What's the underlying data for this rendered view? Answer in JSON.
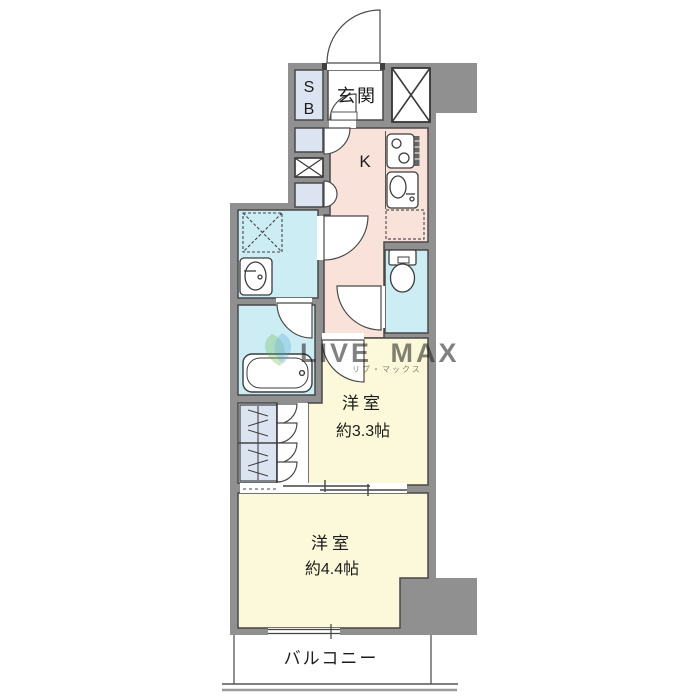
{
  "floorplan": {
    "labels": {
      "shoe_box_line1": "S",
      "shoe_box_line2": "B",
      "entrance": "玄関",
      "kitchen": "K",
      "room1_name": "洋室",
      "room1_size": "約3.3帖",
      "room2_name": "洋室",
      "room2_size": "約4.4帖",
      "balcony": "バルコニー"
    },
    "watermark": {
      "text": "LIVE MAX",
      "subtext": "リブ・マックス",
      "logo": "leaf-logo"
    },
    "icons": [
      "entrance-door-swing",
      "shoe-box",
      "pipe-shaft-cross",
      "meter-box-cross",
      "washing-machine-space",
      "vanity-sink",
      "bathtub",
      "toilet",
      "gas-stove",
      "kitchen-sink",
      "refrigerator-space-dashed",
      "closet-hanger-pole",
      "double-closet-doors",
      "sliding-door",
      "balcony-window"
    ],
    "colors": {
      "wall": "#909090",
      "kitchen_pink": "#f9e2da",
      "room_yellow": "#fbf9d9",
      "wet_cyan": "#cdedf5",
      "storage_lavender": "#dce4f1",
      "outline": "#484848",
      "watermark_blue": "#97a5c9"
    }
  }
}
